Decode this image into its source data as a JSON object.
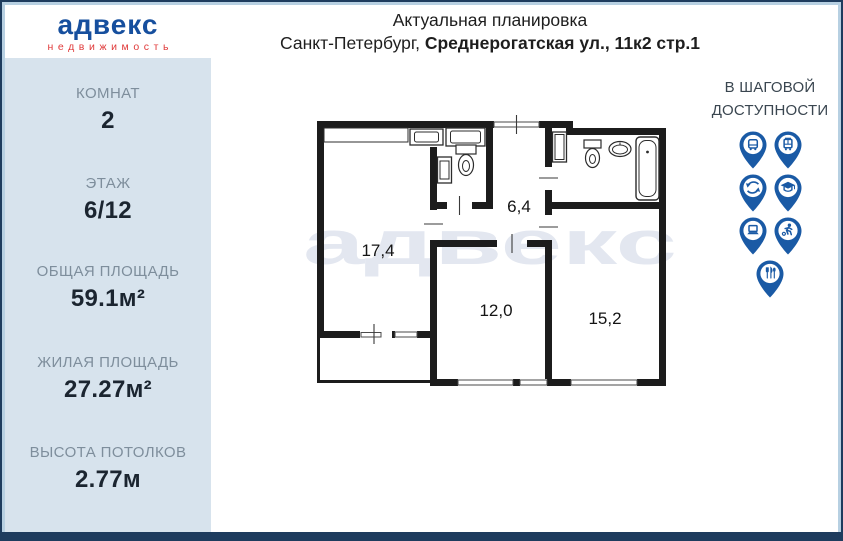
{
  "colors": {
    "frame_navy": "#1e3c5e",
    "frame_light_blue": "#b7d0e2",
    "sidebar_bg": "#d7e3ed",
    "brand_blue": "#164f9e",
    "brand_red": "#e03a3a",
    "pin_blue": "#1a5aa5",
    "watermark_gray": "#e3e7f0"
  },
  "logo": {
    "brand": "адвекс",
    "subtitle": "недвижимость"
  },
  "sidebar": {
    "stats": [
      {
        "label": "КОМНАТ",
        "value": "2"
      },
      {
        "label": "ЭТАЖ",
        "value": "6/12"
      },
      {
        "label": "ОБЩАЯ ПЛОЩАДЬ",
        "value": "59.1м²"
      },
      {
        "label": "ЖИЛАЯ ПЛОЩАДЬ",
        "value": "27.27м²"
      },
      {
        "label": "ВЫСОТА ПОТОЛКОВ",
        "value": "2.77м"
      }
    ]
  },
  "header": {
    "title": "Актуальная планировка",
    "address_prefix": "Санкт-Петербург, ",
    "address_bold": "Среднерогатская ул., 11к2 стр.1"
  },
  "floorplan": {
    "watermark": "адвекс",
    "rooms": {
      "room1": "17,4",
      "hall": "6,4",
      "room2": "12,0",
      "room3": "15,2"
    }
  },
  "nearby": {
    "title_line1": "В ШАГОВОЙ",
    "title_line2": "ДОСТУПНОСТИ",
    "icons": [
      "bus-icon",
      "tram-icon",
      "metro-icon",
      "school-icon",
      "laptop-icon",
      "sports-icon",
      "restaurant-icon"
    ]
  }
}
